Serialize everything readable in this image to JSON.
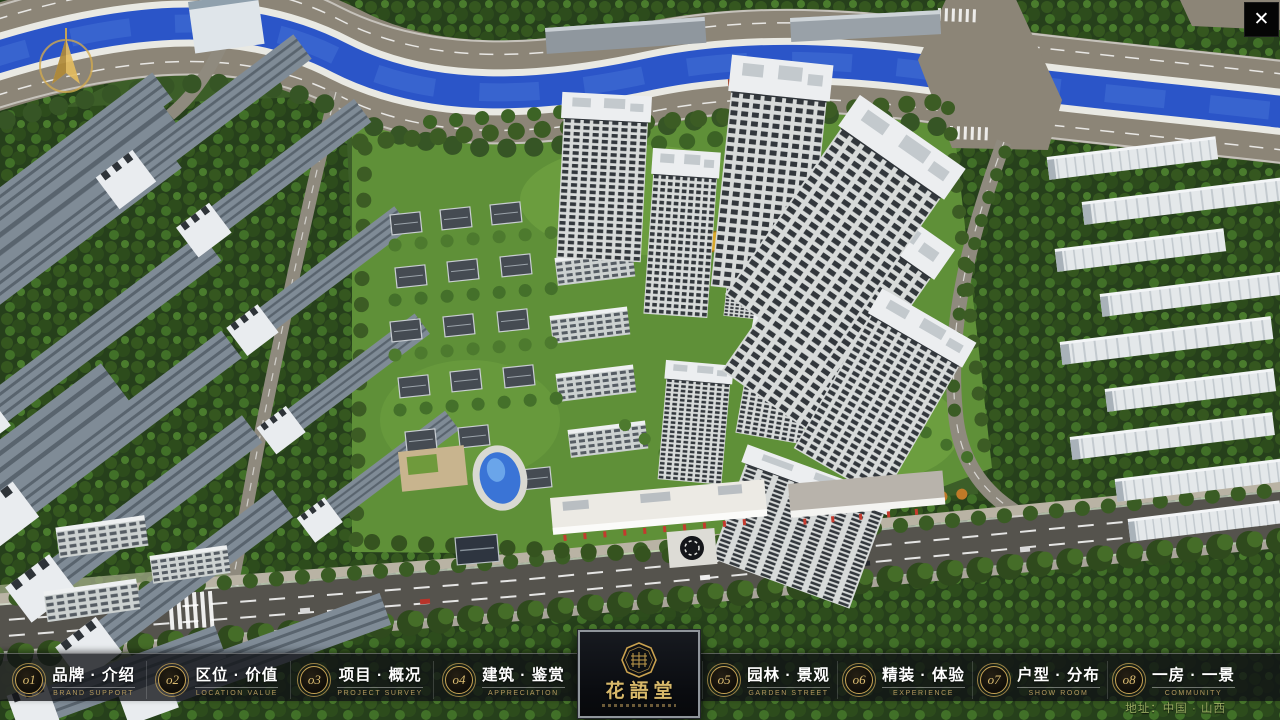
{
  "window": {
    "close_icon": "✕"
  },
  "compass": {
    "icon": "compass-north-arrow"
  },
  "nav": {
    "items": [
      {
        "num": "o1",
        "zh": "品牌 · 介绍",
        "en": "BRAND SUPPORT"
      },
      {
        "num": "o2",
        "zh": "区位 · 价值",
        "en": "LOCATION VALUE"
      },
      {
        "num": "o3",
        "zh": "项目 · 概况",
        "en": "PROJECT SURVEY"
      },
      {
        "num": "o4",
        "zh": "建筑 · 鉴赏",
        "en": "APPRECIATION"
      },
      {
        "num": "o5",
        "zh": "园林 · 景观",
        "en": "GARDEN STREET"
      },
      {
        "num": "o6",
        "zh": "精装 · 体验",
        "en": "EXPERIENCE"
      },
      {
        "num": "o7",
        "zh": "户型 · 分布",
        "en": "SHOW ROOM"
      },
      {
        "num": "o8",
        "zh": "一房 · 一景",
        "en": "COMMUNITY"
      }
    ]
  },
  "logo": {
    "title": "花語堂"
  },
  "footer": {
    "address": "地址：中国 · 山西"
  },
  "colors": {
    "accent_gold": "#c8a454",
    "navbar_bg": "rgba(15,17,21,0.78)",
    "river_blue": "#2b55c8",
    "tree_green": "#2d4c1c",
    "lawn_green": "#5f9038",
    "road_dark": "#55534d",
    "road_tan": "#8c8577",
    "panel_black": "#0b0d10",
    "flag_red": "#c43a2e"
  }
}
